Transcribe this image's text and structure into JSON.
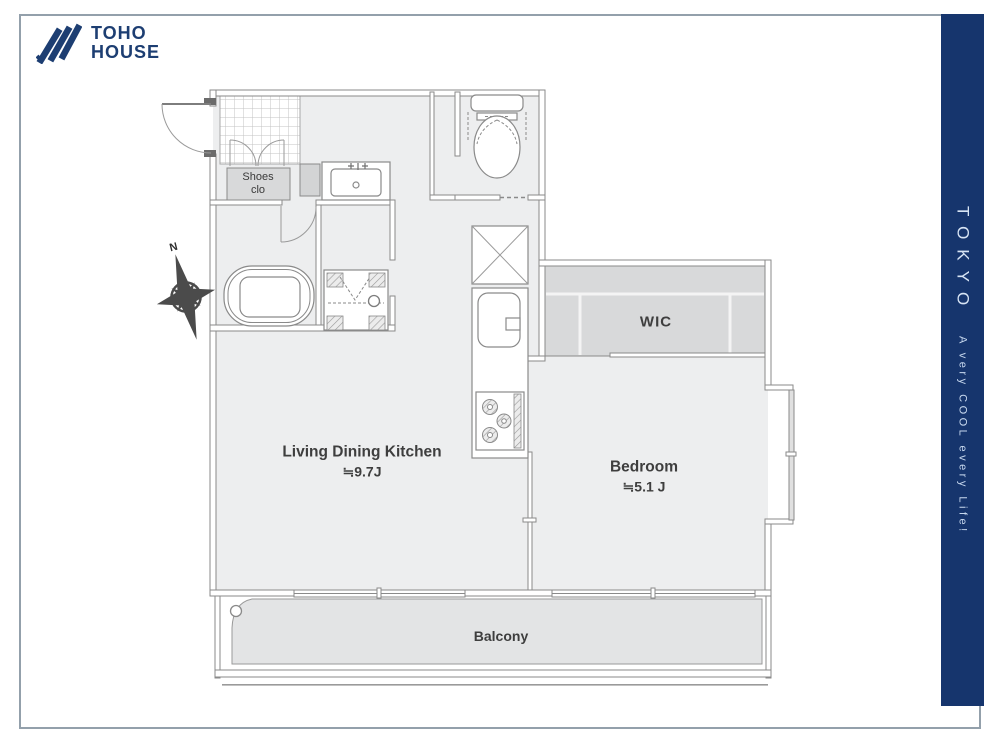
{
  "brand": {
    "line1": "TOHO",
    "line2": "HOUSE",
    "color": "#1d3e72"
  },
  "side_banner": {
    "title": "TOKYO",
    "tagline": "A very COOL every Life!",
    "bg_color": "#16356d",
    "text_color": "#c7d8ee"
  },
  "floor_plan": {
    "labels": {
      "shoes_line1": "Shoes",
      "shoes_line2": "clo",
      "wic": "WIC",
      "ldk_name": "Living Dining Kitchen",
      "ldk_size": "≒9.7J",
      "bedroom_name": "Bedroom",
      "bedroom_size": "≒5.1 J",
      "balcony": "Balcony",
      "compass_north": "N"
    },
    "colors": {
      "wall": "#8a8a8a",
      "floor": "#edeeef",
      "closet_fill": "#d8d9da",
      "balcony_fill": "#e3e4e5"
    }
  }
}
